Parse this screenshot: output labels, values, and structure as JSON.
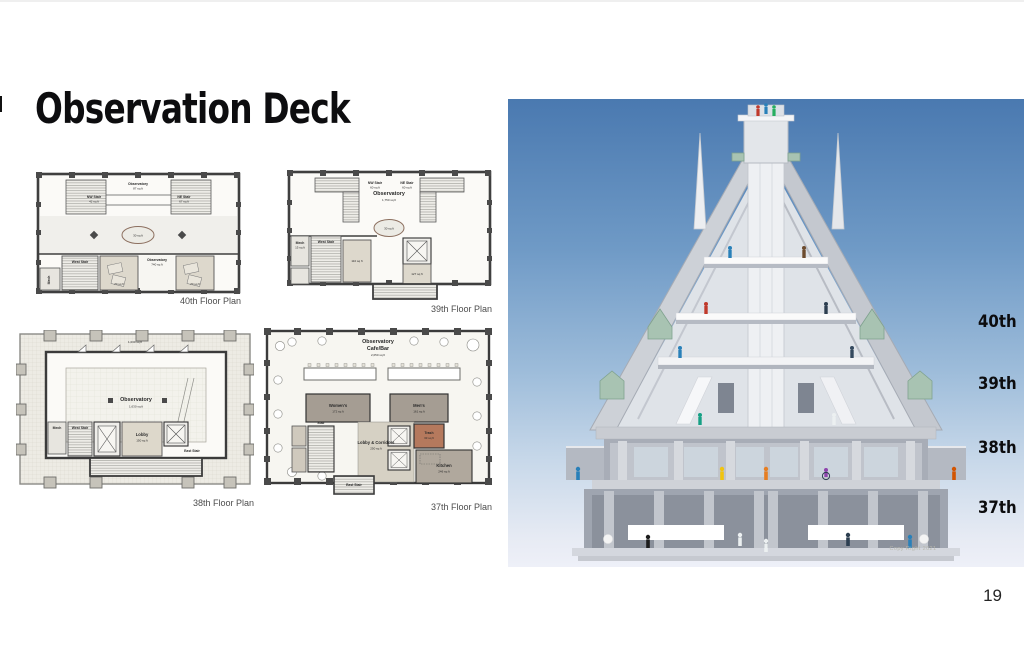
{
  "slide": {
    "title": "Observation Deck",
    "page_number": "19"
  },
  "plans": {
    "p40": {
      "caption": "40th Floor Plan",
      "labels": {
        "observatory_top": "Observatory",
        "observatory_top_area": "87 sq ft",
        "nw_stair": "NW Stair",
        "nw_stair_area": "42 sq ft",
        "ne_stair": "NE Stair",
        "ne_stair_area": "67 sq ft",
        "center_area": "30 sq ft",
        "west_stair": "West Stair",
        "mech": "Mech",
        "observatory_mid": "Observatory",
        "observatory_mid_area": "740 sq ft",
        "room_left_area": "70 sq ft",
        "room_right_area": "70 sq ft"
      }
    },
    "p39": {
      "caption": "39th Floor Plan",
      "labels": {
        "nw_stair": "NW Stair",
        "nw_stair_area": "60 sq ft",
        "observatory": "Observatory",
        "observatory_area": "1,750 sq ft",
        "ne_stair": "NE Stair",
        "ne_stair_area": "60 sq ft",
        "center_area": "30 sq ft",
        "mech": "Mech",
        "mech_area": "15 sq ft",
        "west_stair": "West Stair",
        "room_area": "110 sq ft",
        "elev_lobby_area": "127 sq ft"
      }
    },
    "p38": {
      "caption": "38th Floor Plan",
      "labels": {
        "terrace_area": "1,030 sq ft",
        "observatory": "Observatory",
        "observatory_area": "1,630 sq ft",
        "mech": "Mech",
        "west_stair": "West Stair",
        "lobby": "Lobby",
        "lobby_area": "150 sq ft",
        "east_stair": "East Stair"
      }
    },
    "p37": {
      "caption": "37th Floor Plan",
      "labels": {
        "cafe_name_1": "Observatory",
        "cafe_name_2": "Cafe/Bar",
        "cafe_area": "2,050 sq ft",
        "womens": "Women's",
        "womens_area": "172 sq ft",
        "mens": "Men's",
        "mens_area": "161 sq ft",
        "trash": "Trash",
        "trash_area": "33 sq ft",
        "lobby": "Lobby & Corridors",
        "lobby_area": "250 sq ft",
        "kitchen": "Kitchen",
        "kitchen_area": "246 sq ft",
        "west_stair": "Stair",
        "east_stair": "East Stair"
      }
    }
  },
  "section": {
    "floor_labels": [
      "40th",
      "39th",
      "38th",
      "37th"
    ],
    "watermark": "Copy Right 2021",
    "colors": {
      "sky_top": "#4a79b0",
      "sky_bottom": "#edf0f8",
      "copper": "#a8c3b2",
      "stone": "#cdd1d7"
    }
  }
}
